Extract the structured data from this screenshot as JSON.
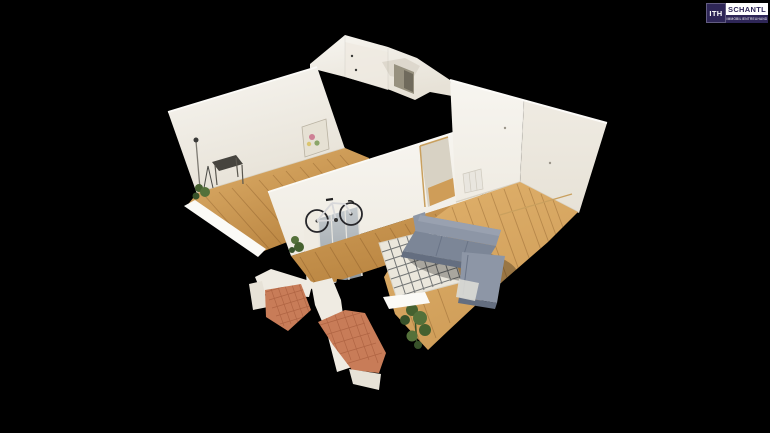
{
  "viewer": {
    "background": "#000000"
  },
  "logo": {
    "icon_text": "ITH",
    "brand": "SCHANTL",
    "tagline": "IMMOBILIENTREUHAND",
    "navy": "#2e2657",
    "brand_text": "#2e2657"
  },
  "colors": {
    "wall_bright": "#f7f5f0",
    "wall_mid": "#efebe2",
    "wall_shade": "#e7e2d7",
    "wall_cut": "#fbfaf6",
    "wall_dark_opening": "#97917f",
    "floor_light": "#e0b16c",
    "floor_mid": "#cf9d58",
    "floor_dark": "#b8833f",
    "plank_line": "rgba(115,72,28,0.32)",
    "rug_base": "#ebe7dc",
    "rug_pattern": "#41464a",
    "sofa_top": "#99a1b0",
    "sofa_body": "#8d96a6",
    "sofa_seat": "#7c8697",
    "sofa_shadow": "#646e80",
    "terracotta": "#c87c58",
    "terracotta_line": "#a3593a",
    "plant_dark": "#38522a",
    "plant_mid": "#45612f",
    "plant_light": "#54713a",
    "wood_trim": "#c9a05e",
    "mirror_light": "#c3c9cd",
    "mirror_dark": "#8f979e",
    "bike_frame": "#d8d8da",
    "bike_dark": "#26262a",
    "canvas_art": "#e6e1d4",
    "throw_white": "#dcdcd6",
    "baseboard": "#d8d2c4"
  },
  "scene": {
    "label": "3D dollhouse view of apartment",
    "objects": [
      "left room",
      "hallway",
      "bathroom block",
      "living room",
      "sofa",
      "area rug",
      "bicycle",
      "mirror wardrobe",
      "floor lamp",
      "desk",
      "painting",
      "plants",
      "terracotta tiles",
      "radiator",
      "doorway"
    ]
  }
}
